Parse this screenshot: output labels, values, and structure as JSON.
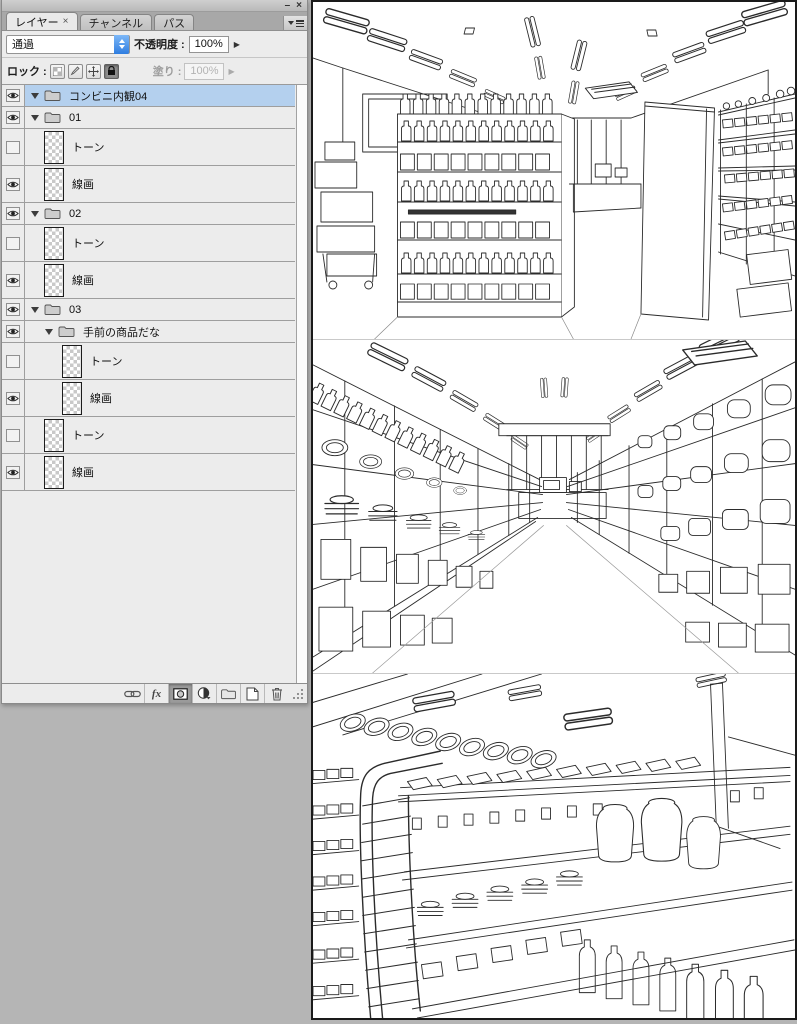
{
  "window": {
    "minimize_glyph": "–",
    "close_glyph": "×"
  },
  "colors": {
    "selection_blue": "#b4d0ee",
    "stepper_blue": "#3f8fe8",
    "desktop_gray": "#b5b5b5",
    "panel_gray": "#ececec",
    "line_ink": "#2b2b2b"
  },
  "panel": {
    "tabs": [
      {
        "label": "レイヤー",
        "close_glyph": "×",
        "active": true
      },
      {
        "label": "チャンネル",
        "active": false
      },
      {
        "label": "パス",
        "active": false
      }
    ],
    "blend_mode": {
      "value": "通過"
    },
    "opacity": {
      "label": "不透明度 :",
      "value": "100%",
      "arrow_glyph": "▶"
    },
    "lock": {
      "label": "ロック :",
      "buttons": [
        "lock-transparency",
        "lock-paint",
        "lock-position",
        "lock-all"
      ],
      "lock_all_pressed": true
    },
    "fill": {
      "label": "塗り :",
      "value": "100%",
      "arrow_glyph": "▶",
      "disabled": true
    },
    "layers": [
      {
        "type": "group",
        "name": "コンビニ内観04",
        "visible": true,
        "expanded": true,
        "selected": true,
        "depth": 0
      },
      {
        "type": "group",
        "name": "01",
        "visible": true,
        "expanded": true,
        "selected": false,
        "depth": 0
      },
      {
        "type": "layer",
        "name": "トーン",
        "visible": false,
        "selected": false,
        "depth": 1
      },
      {
        "type": "layer",
        "name": "線画",
        "visible": true,
        "selected": false,
        "depth": 1
      },
      {
        "type": "group",
        "name": "02",
        "visible": true,
        "expanded": true,
        "selected": false,
        "depth": 0
      },
      {
        "type": "layer",
        "name": "トーン",
        "visible": false,
        "selected": false,
        "depth": 1
      },
      {
        "type": "layer",
        "name": "線画",
        "visible": true,
        "selected": false,
        "depth": 1
      },
      {
        "type": "group",
        "name": "03",
        "visible": true,
        "expanded": true,
        "selected": false,
        "depth": 0
      },
      {
        "type": "group",
        "name": "手前の商品だな",
        "visible": true,
        "expanded": true,
        "selected": false,
        "depth": 1
      },
      {
        "type": "layer",
        "name": "トーン",
        "visible": false,
        "selected": false,
        "depth": 2
      },
      {
        "type": "layer",
        "name": "線画",
        "visible": true,
        "selected": false,
        "depth": 2
      },
      {
        "type": "layer",
        "name": "トーン",
        "visible": false,
        "selected": false,
        "depth": 1
      },
      {
        "type": "layer",
        "name": "線画",
        "visible": true,
        "selected": false,
        "depth": 1
      }
    ],
    "footer": {
      "fx_label": "fx",
      "icons": [
        "link-layers",
        "layer-style-fx",
        "add-layer-mask",
        "new-adjustment-layer",
        "new-group",
        "new-layer",
        "delete-layer"
      ]
    }
  },
  "canvas": {
    "images": [
      {
        "name": "convenience-store-interior-overview-lineart"
      },
      {
        "name": "convenience-store-aisle-perspective-lineart"
      },
      {
        "name": "convenience-store-shelf-closeup-lineart"
      }
    ]
  }
}
